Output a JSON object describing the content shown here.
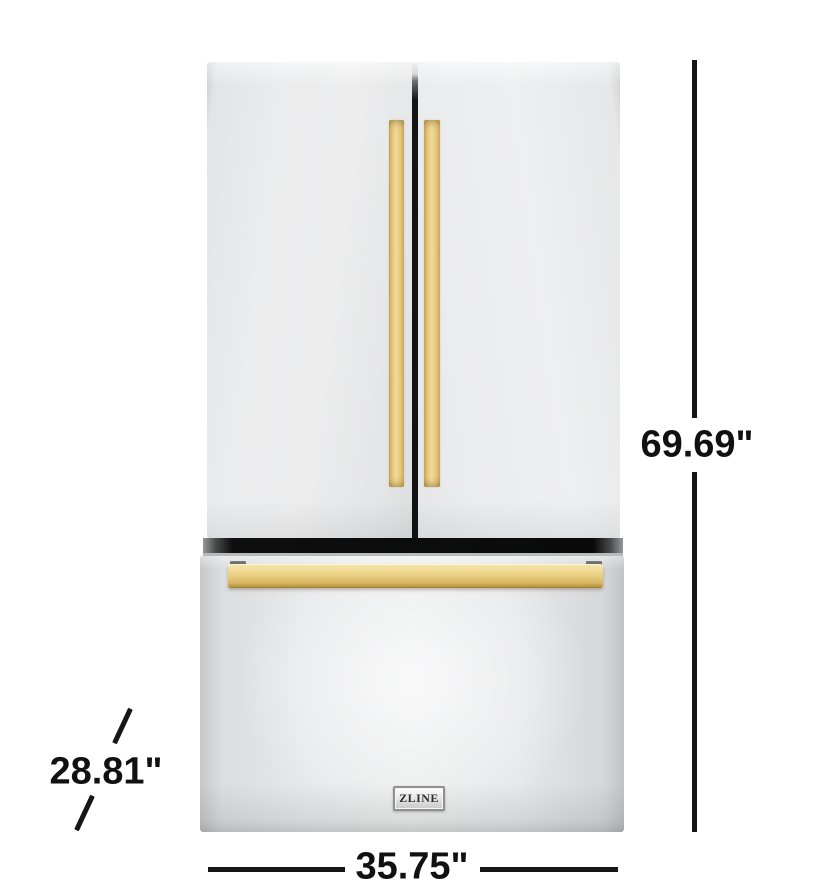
{
  "product": {
    "brand": "ZLINE"
  },
  "annotations": {
    "height": "69.69\"",
    "width": "35.75\"",
    "depth": "28.81\""
  },
  "colors": {
    "handle_gold": "#E9CD84",
    "drawer_handle_gold": "#E6C97C",
    "dimension_line": "#161616",
    "stainless_steel": "#EAEBEC",
    "dispenser_recess": "#242424"
  }
}
